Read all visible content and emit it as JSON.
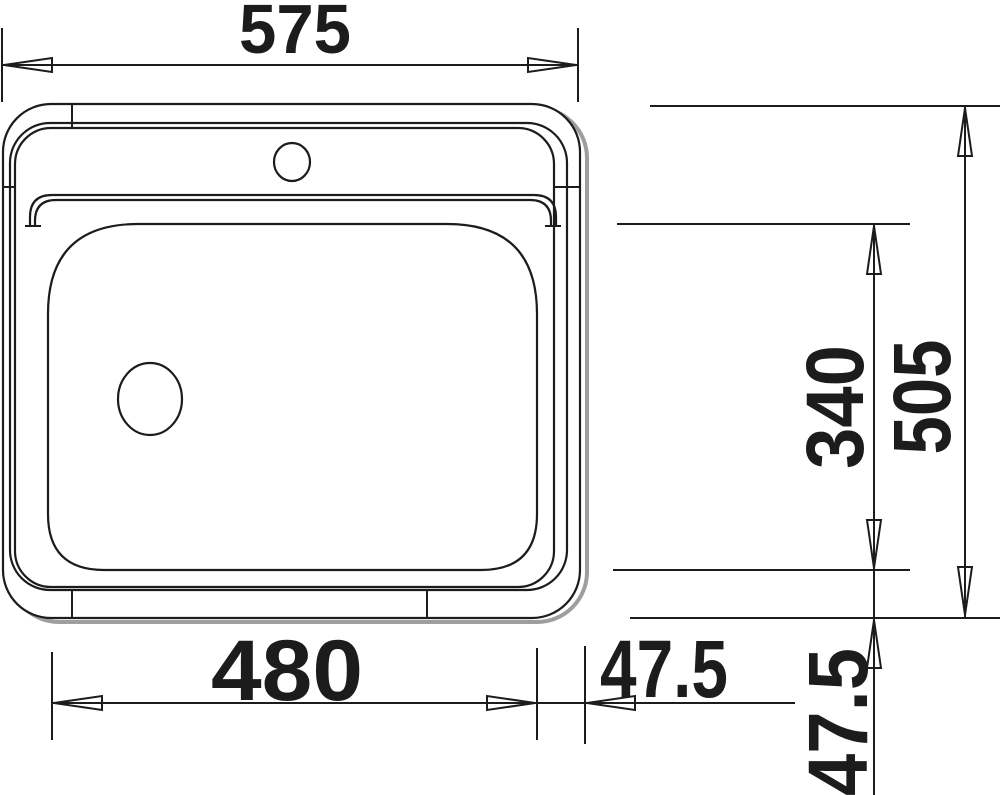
{
  "diagram": {
    "subject": "sink-top-view-dimension-drawing",
    "colors": {
      "line": "#1c1c1c",
      "shadow": "#9e9e9e",
      "background": "#ffffff"
    },
    "dims": {
      "overall_width": "575",
      "bowl_width": "480",
      "side_offset": "47.5",
      "bowl_depth": "340",
      "overall_depth": "505",
      "bottom_offset": "47.5"
    }
  }
}
